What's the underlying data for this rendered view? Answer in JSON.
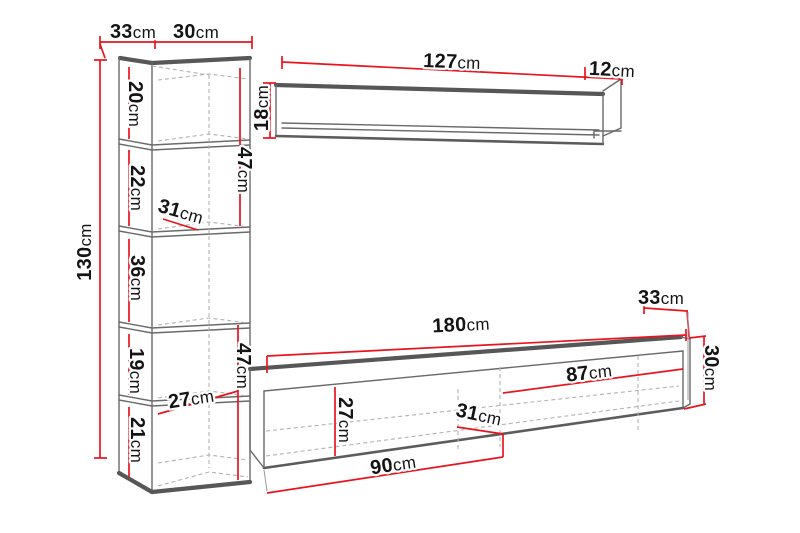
{
  "diagram": {
    "title": "Wall unit furniture set dimension diagram",
    "unit": "cm",
    "pieces": {
      "tall_cabinet": {
        "top_depth": "33",
        "top_width": "30",
        "height": "130",
        "shelf_sections": [
          "20",
          "22",
          "36",
          "19",
          "21"
        ],
        "inner_widths": [
          "31",
          "27"
        ],
        "inner_heights": [
          "47",
          "47"
        ]
      },
      "wall_shelf": {
        "length": "127",
        "end_depth": "12",
        "height": "18"
      },
      "tv_stand": {
        "length": "180",
        "depth": "33",
        "height": "30",
        "right_compartment_width": "87",
        "inner_width": "31",
        "inner_height": "27",
        "left_compartment_width": "90"
      }
    },
    "labels": [
      {
        "id": "cabinet-top-depth",
        "value": "33",
        "unit": "cm"
      },
      {
        "id": "cabinet-top-width",
        "value": "30",
        "unit": "cm"
      },
      {
        "id": "cabinet-height",
        "value": "130",
        "unit": "cm"
      },
      {
        "id": "cabinet-section-1",
        "value": "20",
        "unit": "cm"
      },
      {
        "id": "cabinet-section-2",
        "value": "22",
        "unit": "cm"
      },
      {
        "id": "cabinet-inner-width-upper",
        "value": "31",
        "unit": "cm"
      },
      {
        "id": "cabinet-section-3",
        "value": "36",
        "unit": "cm"
      },
      {
        "id": "cabinet-inner-height-upper",
        "value": "47",
        "unit": "cm"
      },
      {
        "id": "cabinet-section-4",
        "value": "19",
        "unit": "cm"
      },
      {
        "id": "cabinet-inner-width-lower",
        "value": "27",
        "unit": "cm"
      },
      {
        "id": "cabinet-section-5",
        "value": "21",
        "unit": "cm"
      },
      {
        "id": "cabinet-inner-height-lower",
        "value": "47",
        "unit": "cm"
      },
      {
        "id": "shelf-length",
        "value": "127",
        "unit": "cm"
      },
      {
        "id": "shelf-end-depth",
        "value": "12",
        "unit": "cm"
      },
      {
        "id": "shelf-height",
        "value": "18",
        "unit": "cm"
      },
      {
        "id": "stand-length",
        "value": "180",
        "unit": "cm"
      },
      {
        "id": "stand-depth",
        "value": "33",
        "unit": "cm"
      },
      {
        "id": "stand-height",
        "value": "30",
        "unit": "cm"
      },
      {
        "id": "stand-inner-width-87",
        "value": "87",
        "unit": "cm"
      },
      {
        "id": "stand-inner-width-31",
        "value": "31",
        "unit": "cm"
      },
      {
        "id": "stand-inner-height-27",
        "value": "27",
        "unit": "cm"
      },
      {
        "id": "stand-bottom-width-90",
        "value": "90",
        "unit": "cm"
      }
    ]
  },
  "colors": {
    "dimension_line": "#e8141e",
    "outline": "#5c5c5c",
    "dashed_line": "#b2b2b2",
    "label_text": "#141414",
    "background": "#ffffff"
  }
}
